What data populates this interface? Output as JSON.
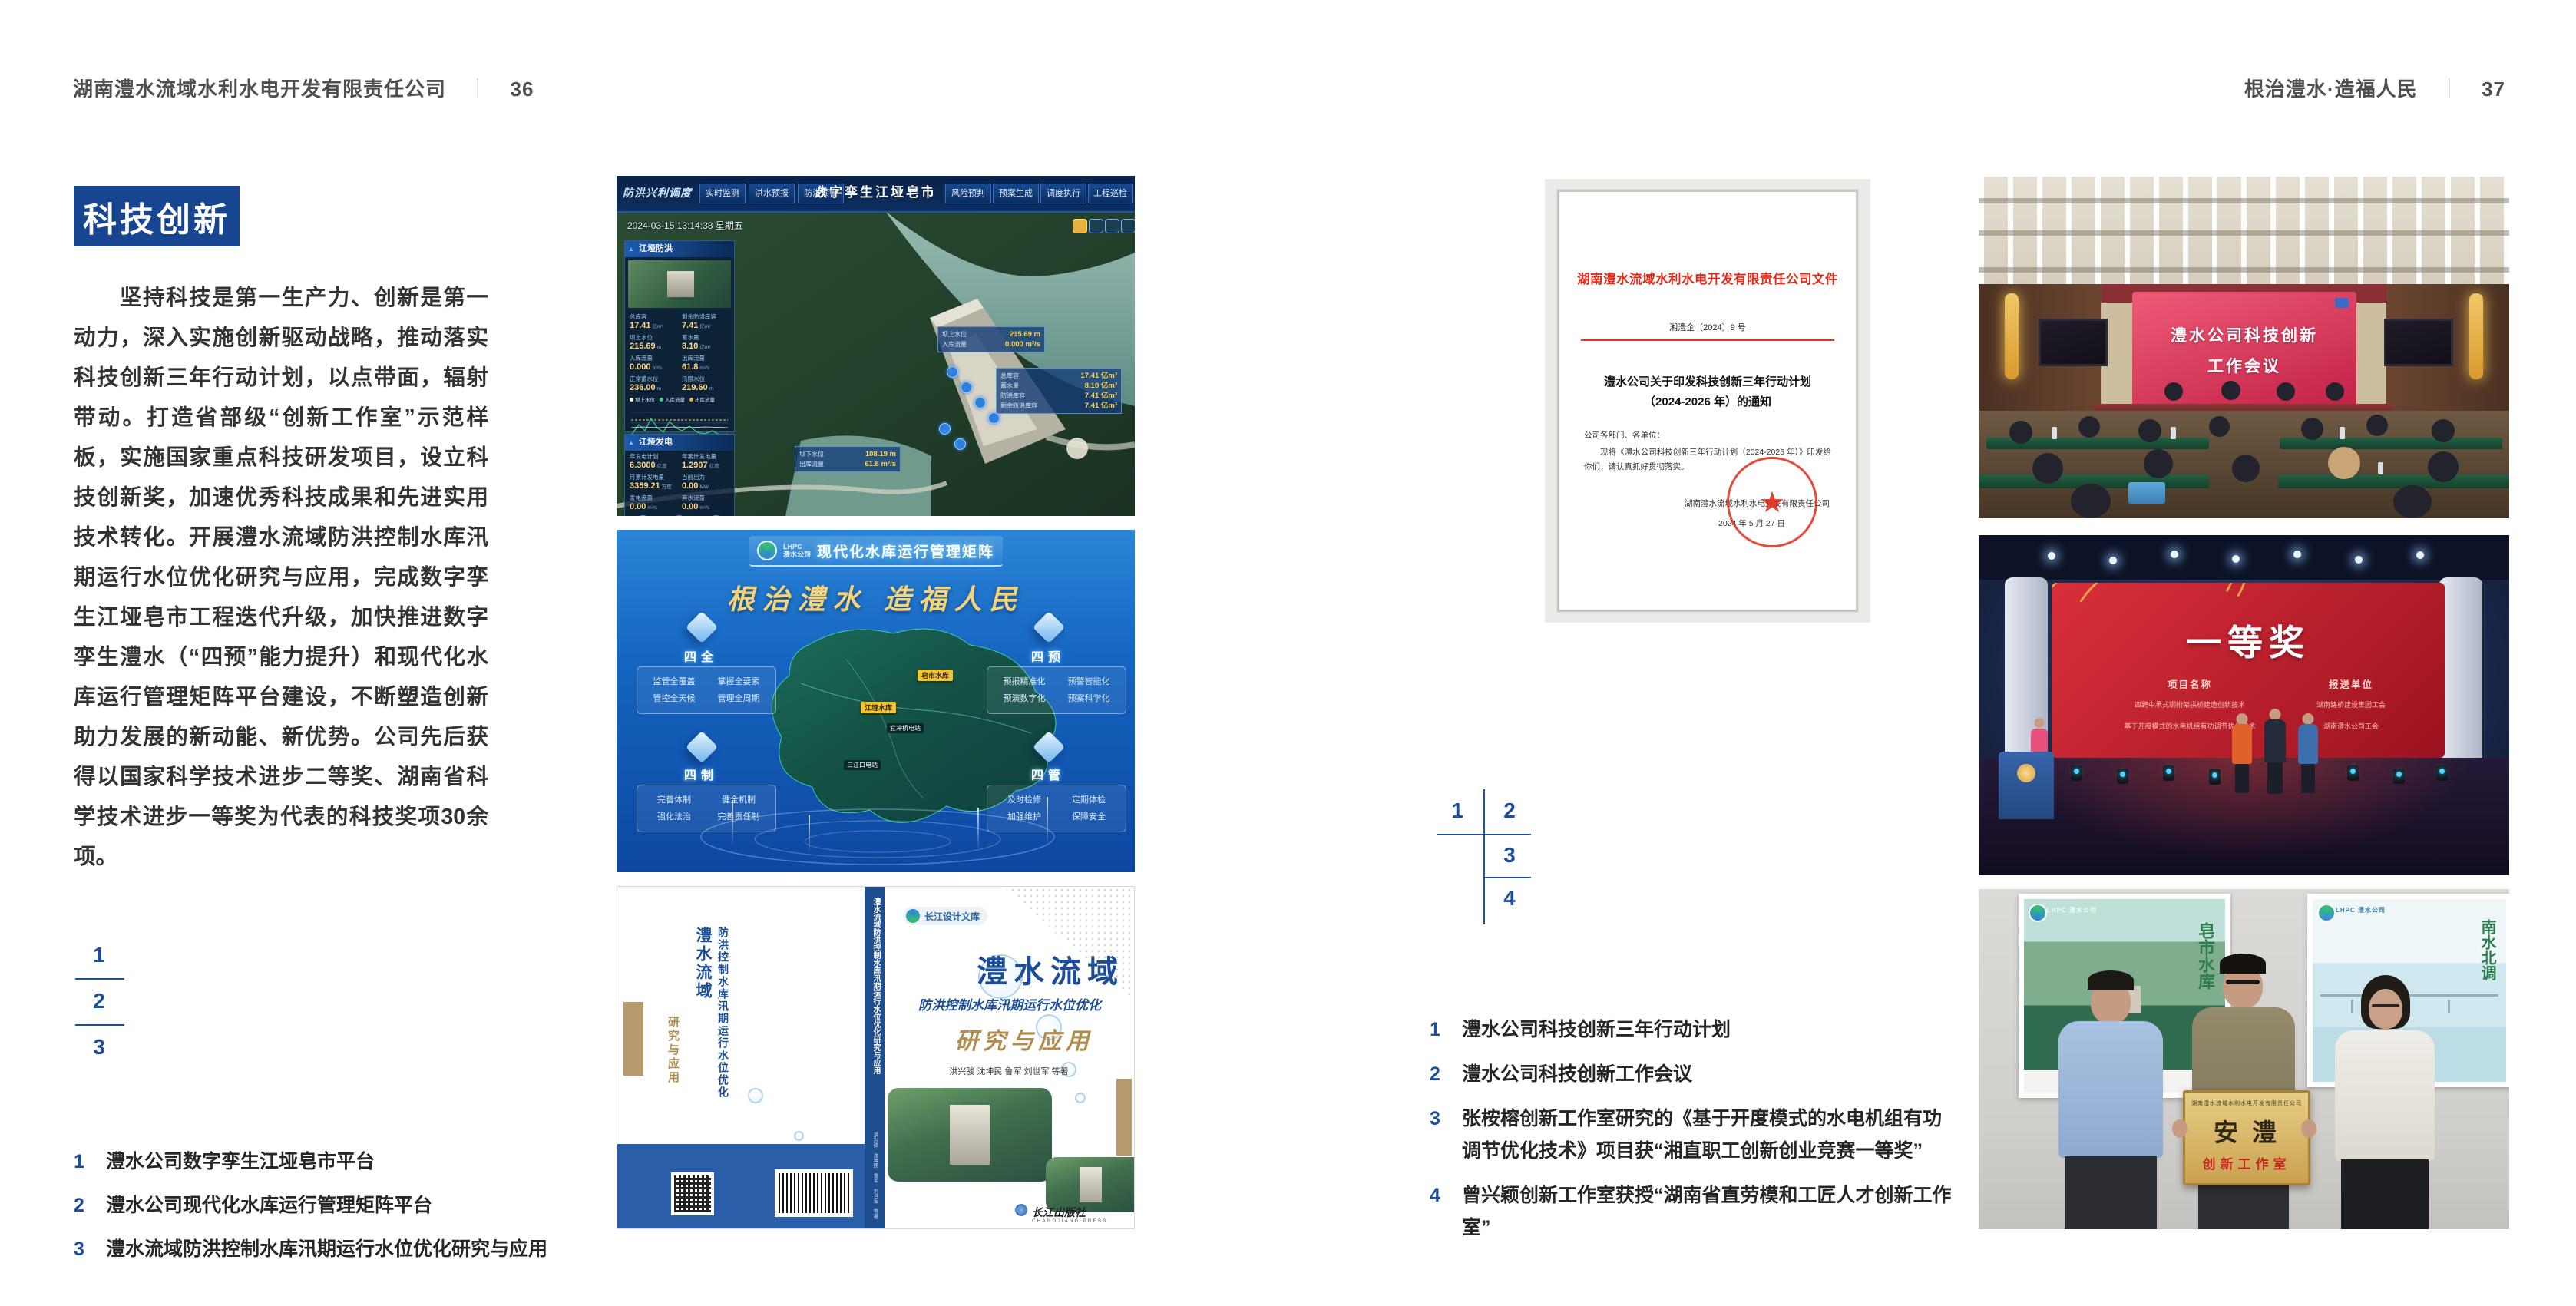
{
  "colors": {
    "accent_blue": "#17458f",
    "index_blue": "#1d4f9c",
    "doc_red": "#e02a1a",
    "gold": "#b9984f"
  },
  "left_page": {
    "header": {
      "company": "湖南澧水流域水利水电开发有限责任公司",
      "separator": "｜",
      "page_number": "36"
    },
    "section_title": "科技创新",
    "paragraph": "坚持科技是第一生产力、创新是第一动力，深入实施创新驱动战略，推动落实科技创新三年行动计划，以点带面，辐射带动。打造省部级“创新工作室”示范样板，实施国家重点科技研发项目，设立科技创新奖，加速优秀科技成果和先进实用技术转化。开展澧水流域防洪控制水库汛期运行水位优化研究与应用，完成数字孪生江垭皂市工程迭代升级，加快推进数字孪生澧水（“四预”能力提升）和现代化水库运行管理矩阵平台建设，不断塑造创新助力发展的新动能、新优势。公司先后获得以国家科学技术进步二等奖、湖南省科学技术进步一等奖为代表的科技奖项30余项。",
    "figure_index": [
      "1",
      "2",
      "3"
    ],
    "captions": [
      {
        "num": "1",
        "text": "澧水公司数字孪生江垭皂市平台"
      },
      {
        "num": "2",
        "text": "澧水公司现代化水库运行管理矩阵平台"
      },
      {
        "num": "3",
        "text": "澧水流域防洪控制水库汛期运行水位优化研究与应用"
      }
    ]
  },
  "right_page": {
    "header": {
      "slogan": "根治澧水·造福人民",
      "separator": "｜",
      "page_number": "37"
    },
    "figure_index": [
      "1",
      "2",
      "3",
      "4"
    ],
    "captions": [
      {
        "num": "1",
        "text": "澧水公司科技创新三年行动计划"
      },
      {
        "num": "2",
        "text": "澧水公司科技创新工作会议"
      },
      {
        "num": "3",
        "text": "张桉榕创新工作室研究的《基于开度模式的水电机组有功调节优化技术》项目获“湘直职工创新创业竞赛一等奖”"
      },
      {
        "num": "4",
        "text": "曾兴颖创新工作室获授“湖南省直劳模和工匠人才创新工作室”"
      }
    ]
  },
  "dashboard": {
    "brand": "防洪兴利调度",
    "title": "数字孪生江垭皂市",
    "tabs_left": [
      "实时监测",
      "洪水预报",
      "防洪预警"
    ],
    "tabs_right": [
      "风险预判",
      "预案生成",
      "调度执行",
      "工程巡检"
    ],
    "datetime": "2024-03-15 13:14:38 星期五",
    "panel_flood": {
      "title": "江垭防洪",
      "stats": [
        {
          "label": "总库容",
          "value": "17.41",
          "unit": "亿m³"
        },
        {
          "label": "剩余防洪库容",
          "value": "7.41",
          "unit": "亿m³"
        },
        {
          "label": "坝上水位",
          "value": "215.69",
          "unit": "m"
        },
        {
          "label": "蓄水量",
          "value": "8.10",
          "unit": "亿m³"
        },
        {
          "label": "入库流量",
          "value": "0.000",
          "unit": "m³/s"
        },
        {
          "label": "出库流量",
          "value": "61.8",
          "unit": "m³/s"
        },
        {
          "label": "正常蓄水位",
          "value": "236.00",
          "unit": "m"
        },
        {
          "label": "汛限水位",
          "value": "219.60",
          "unit": "m"
        }
      ],
      "chart_legend": [
        "坝上水位",
        "入库流量",
        "出库流量"
      ],
      "chart_x": [
        "03-12",
        "03-13",
        "03-14"
      ]
    },
    "panel_power": {
      "title": "江垭发电",
      "stats": [
        {
          "label": "年发电计划",
          "value": "6.3000",
          "unit": "亿度"
        },
        {
          "label": "年累计发电量",
          "value": "1.2907",
          "unit": "亿度"
        },
        {
          "label": "月累计发电量",
          "value": "3359.21",
          "unit": "万度"
        },
        {
          "label": "当前出力",
          "value": "0.00",
          "unit": "MW"
        },
        {
          "label": "发电流量",
          "value": "0.00",
          "unit": "m³/s"
        },
        {
          "label": "弃水流量",
          "value": "0.00",
          "unit": "m³/s"
        }
      ],
      "gauges": [
        "0.00",
        "100.98",
        "0.00"
      ]
    },
    "map_tags": {
      "upstream": [
        {
          "label": "坝上水位",
          "value": "215.69 m"
        },
        {
          "label": "入库流量",
          "value": "0.000 m³/s"
        }
      ],
      "reservoir": [
        {
          "label": "总库容",
          "value": "17.41 亿m³"
        },
        {
          "label": "蓄水量",
          "value": "8.10 亿m³"
        },
        {
          "label": "防洪库容",
          "value": "7.41 亿m³"
        },
        {
          "label": "剩余防洪库容",
          "value": "7.41 亿m³"
        }
      ],
      "downstream": [
        {
          "label": "坝下水位",
          "value": "108.19 m"
        },
        {
          "label": "出库流量",
          "value": "61.8 m³/s"
        }
      ]
    }
  },
  "platform": {
    "logo_abbr": "LHPC",
    "logo_name": "澧水公司",
    "title": "现代化水库运行管理矩阵",
    "slogan": "根治澧水 造福人民",
    "modules": [
      {
        "name": "四全",
        "items": [
          "监管全覆盖",
          "掌握全要素",
          "管控全天候",
          "管理全周期"
        ]
      },
      {
        "name": "四预",
        "items": [
          "预报精准化",
          "预警智能化",
          "预演数字化",
          "预案科学化"
        ]
      },
      {
        "name": "四制",
        "items": [
          "完善体制",
          "健全机制",
          "强化法治",
          "完善责任制"
        ]
      },
      {
        "name": "四管",
        "items": [
          "及时检修",
          "定期体检",
          "加强维护",
          "保障安全"
        ]
      }
    ],
    "map_labels_major": [
      "皂市水库",
      "江垭水库"
    ],
    "map_labels_minor": [
      "宜冲桥电站",
      "三江口电站"
    ]
  },
  "book": {
    "series": "长江设计文库",
    "title_main": "澧水流域",
    "title_sub": "防洪控制水库汛期运行水位优化",
    "title_tail": "研究与应用",
    "authors": "洪兴骏 沈坤民 鲁军 刘世军 等著",
    "spine_text": "澧水流域防洪控制水库汛期运行水位优化研究与应用",
    "back_col1": "澧水流域",
    "back_col2": "防洪控制水库汛期运行水位优化",
    "back_tail": "研究与应用",
    "publisher": "长江出版社",
    "publisher_en": "CHANGJIANG PRESS"
  },
  "document": {
    "header": "湖南澧水流域水利水电开发有限责任公司文件",
    "doc_no": "湘澧企〔2024〕9 号",
    "title_line1": "澧水公司关于印发科技创新三年行动计划",
    "title_line2": "（2024-2026 年）的通知",
    "salutation": "公司各部门、各单位：",
    "body": "现将《澧水公司科技创新三年行动计划（2024-2026 年）》印发给你们，请认真抓好贯彻落实。",
    "signer": "湖南澧水流域水利水电开发有限责任公司",
    "date": "2024 年 5 月 27 日",
    "seal_star": "★"
  },
  "meeting": {
    "screen_line1": "澧水公司科技创新",
    "screen_line2": "工作会议"
  },
  "award": {
    "headline": "一等奖",
    "col1_header": "项目名称",
    "col2_header": "报送单位",
    "rows": [
      {
        "project": "四跨中承式钢桁架拱桥建造创新技术",
        "unit": "湖南路桥建设集团工会"
      },
      {
        "project": "基于开度模式的水电机组有功调节优化技术",
        "unit": "湖南澧水公司工会"
      }
    ]
  },
  "group_photo": {
    "plaque_org": "湖南澧水流域水利水电开发有限责任公司",
    "plaque_title": "安澧",
    "plaque_sub": "创新工作室",
    "poster_left_logo": "LHPC 澧水公司",
    "poster_right_logo": "LHPC 澧水公司",
    "poster_left_calligraphy": "皂市水库",
    "poster_right_calligraphy": "南水北调"
  }
}
